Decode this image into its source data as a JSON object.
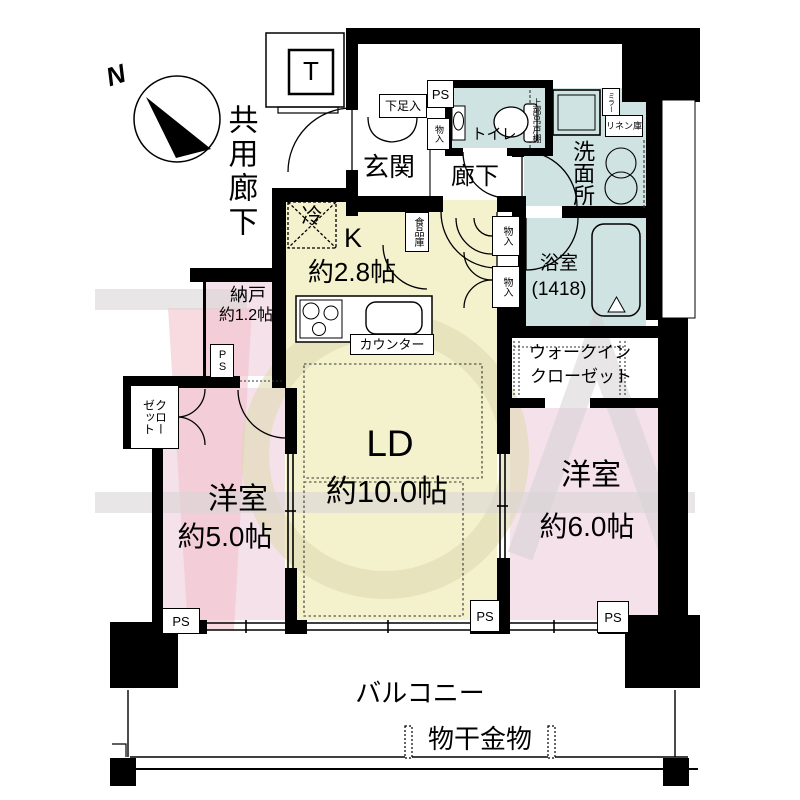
{
  "plan": {
    "compass": {
      "north": "N"
    },
    "common": {
      "corridor": "共用廊下",
      "elevator": "T"
    },
    "entrance": {
      "label": "玄関",
      "shoe_box": "下足入",
      "pipe_space": "PS",
      "storage": "物入"
    },
    "hallway": {
      "label": "廊下"
    },
    "toilet": {
      "label": "トイレ",
      "upper_cabinet": "上部吊戸棚"
    },
    "washroom": {
      "label": "洗面所",
      "linen": "リネン庫",
      "mirror": "ミラー",
      "mirror_cabinet": "上部三面鏡収納"
    },
    "bathroom": {
      "label": "浴室",
      "size": "(1418)"
    },
    "kitchen": {
      "label": "K",
      "size": "約2.8帖",
      "fridge": "冷",
      "pantry": "食品庫",
      "counter": "カウンター",
      "storage_upper": "物入",
      "storage_lower": "物入"
    },
    "living": {
      "label": "LD",
      "size": "約10.0帖",
      "pipe_space": "PS"
    },
    "storage_room": {
      "label": "納戸",
      "size": "約1.2帖",
      "pipe_space": "PS"
    },
    "bedroom_west": {
      "label": "洋室",
      "size": "約5.0帖",
      "pipe_space": "PS",
      "closet": "クロー\nゼット"
    },
    "bedroom_east": {
      "label": "洋室",
      "size": "約6.0帖",
      "pipe_space": "PS"
    },
    "walk_in_closet": {
      "line1": "ウォークイン",
      "line2": "クローゼット"
    },
    "balcony": {
      "label": "バルコニー",
      "drying_hardware": "物干金物"
    }
  }
}
